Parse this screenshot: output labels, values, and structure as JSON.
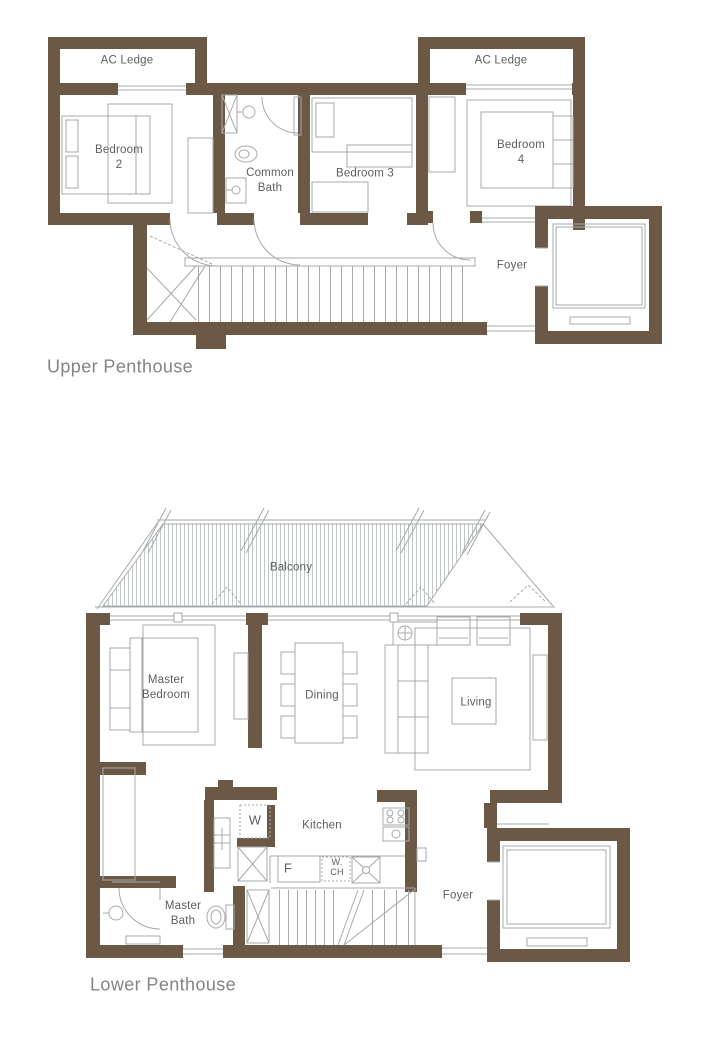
{
  "colors": {
    "wall": "#6b5946",
    "furniture_line": "#a6aaad",
    "label_text": "#5c5e60",
    "title_text": "#828487",
    "background": "#ffffff"
  },
  "upper_floor": {
    "title": "Upper Penthouse",
    "labels": {
      "ac_ledge_left": "AC Ledge",
      "ac_ledge_right": "AC Ledge",
      "bedroom2_l1": "Bedroom",
      "bedroom2_l2": "2",
      "common_bath_l1": "Common",
      "common_bath_l2": "Bath",
      "bedroom3": "Bedroom 3",
      "bedroom4_l1": "Bedroom",
      "bedroom4_l2": "4",
      "foyer": "Foyer"
    }
  },
  "lower_floor": {
    "title": "Lower Penthouse",
    "labels": {
      "balcony": "Balcony",
      "master_bedroom_l1": "Master",
      "master_bedroom_l2": "Bedroom",
      "dining": "Dining",
      "living": "Living",
      "kitchen": "Kitchen",
      "washer": "W",
      "fridge": "F",
      "wch_l1": "W.",
      "wch_l2": "CH",
      "master_bath_l1": "Master",
      "master_bath_l2": "Bath",
      "foyer": "Foyer"
    }
  }
}
